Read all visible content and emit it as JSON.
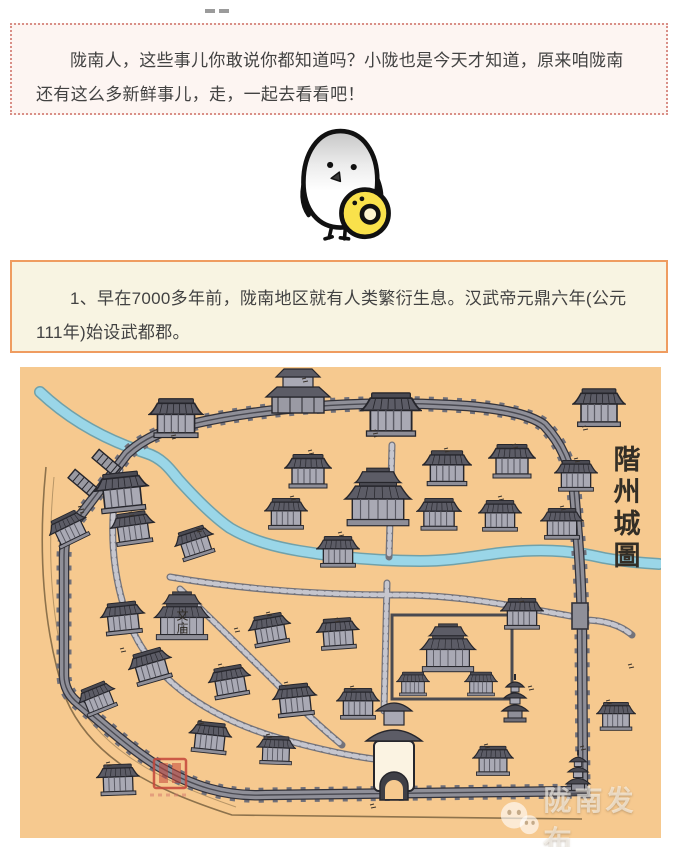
{
  "intro_box": {
    "text": "陇南人，这些事儿你敢说你都知道吗？小陇也是今天才知道，原来咱陇南还有这么多新鲜事儿，走，一起去看看吧！"
  },
  "fact_box": {
    "text": "1、早在7000多年前，陇南地区就有人类繁衍生息。汉武帝元鼎六年(公元111年)始设武都郡。"
  },
  "illustration": {
    "description": "white chick cartoon holding yellow ball"
  },
  "map": {
    "title": "階州城圖",
    "label_wenmiao": "文庙"
  },
  "watermark": {
    "text": "陇南发布"
  },
  "colors": {
    "intro_border": "#d98f87",
    "intro_bg": "#fdf5f2",
    "fact_border": "#ef9c60",
    "fact_bg": "#f8f4e2",
    "map_bg": "#f6c98f",
    "river": "#93d2e6",
    "wall": "#8d8d96",
    "roof": "#5c5c66",
    "seal_red": "#c4453a",
    "chick_ball": "#f9e14b"
  }
}
